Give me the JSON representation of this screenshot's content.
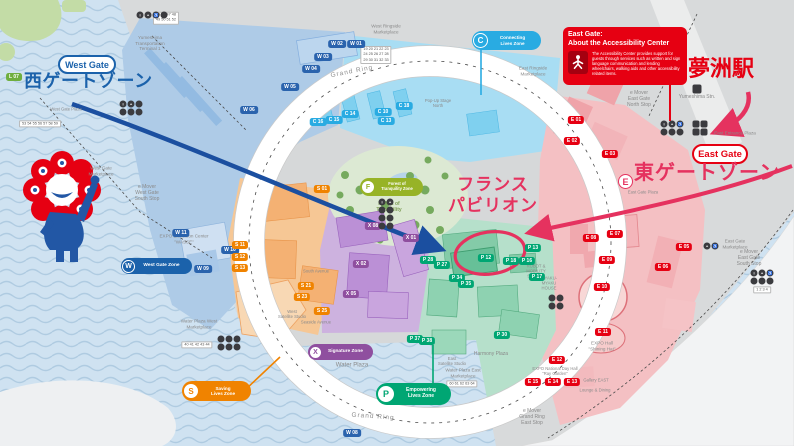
{
  "colors": {
    "water": "#cfe2f1",
    "land": "#d8dadb",
    "west_zone": "#1b62ab",
    "connecting_zone": "#29abe2",
    "saving_zone": "#f08300",
    "signature_zone": "#8f4f9f",
    "empowering_zone": "#00a673",
    "forest_zone": "#97b327",
    "east_zone": "#e60012",
    "annotation_pink": "#e5325f",
    "annotation_blue": "#1b4fa0"
  },
  "overlay": {
    "west_gate_pill": "West Gate",
    "west_zone_text": "西ゲートゾーン",
    "east_gate_pill": "East Gate",
    "east_zone_letter": "E",
    "east_zone_text": "東ゲートゾーン",
    "station_text": "夢洲駅",
    "france_text": "フランス\nパビリオン",
    "accessibility": {
      "title1": "East Gate:",
      "title2": "About the Accessibility Center",
      "body": "The Accessibility Center provides support for guests through services such as written and sign language communication and lending wheelchairs, walking aids and other accessibility related items."
    }
  },
  "zone_pills": [
    {
      "letter": "C",
      "label": "Connecting\nLives Zone"
    },
    {
      "letter": "W",
      "label": "West Gate Zone"
    },
    {
      "letter": "S",
      "label": "Saving\nLives Zone"
    },
    {
      "letter": "X",
      "label": "Signature Zone"
    },
    {
      "letter": "P",
      "label": "Empowering\nLives Zone"
    },
    {
      "letter": "F",
      "label": "Forest of\nTranquility Zone"
    }
  ],
  "labels": [
    "Grand Ring",
    "Grand Ring",
    "Water Plaza",
    "Harmony Plaza",
    "Forest of\nTranquility",
    "Yumeshima Stn.",
    "e Mover\nEast Gate\nNorth Stop",
    "e Mover\nEast Gate\nSouth Stop",
    "e Mover\nWest Gate\nSouth Stop",
    "e Mover\nGrand Ring\nEast Stop",
    "East Entrance Plaza",
    "East Gate\nMarketplace",
    "West Gate\nMarketplace",
    "EXPO Exhibition Center\n\"WASSE\"",
    "Water Plaza West\nMarketplace",
    "Water Plaza East\nMarketplace",
    "East\nSatellite Studio",
    "West\nSatellite Studio",
    "Seaside Avenue",
    "South Avenue",
    "East Ringside\nMarketplace",
    "West Ringside\nMarketplace",
    "EXPO Hall\n\"Shining Hat\"",
    "EXPO National Day Hall\n\"Ray Garden\"",
    "Gallery EAST",
    "Lounge & Dining",
    "Pop-Up Stage\nNorth",
    "ROBOT &\nMOBILITY\nSTATION",
    "MYAKU-\nMYAKU\nHOUSE",
    "Yumeshima\nTransportation\nTerminal 1",
    "East Gate Plaza",
    "West Gate Plaza",
    "45 46 47 48\n49 50 51 52",
    "60 61 62 63 64",
    "40 41 42 43 44",
    "53 54 55 56 57 58 59",
    "19 20 21 22 23\n24 25 26 27 28\n29 30 31 32 33",
    "1 2 3 4"
  ],
  "badges": [
    "W 01",
    "W 02",
    "W 03",
    "W 04",
    "W 05",
    "W 06",
    "W 08",
    "W 09",
    "W 10",
    "W 11",
    "C 10",
    "C 13",
    "C 14",
    "C 15",
    "C 16",
    "C 18",
    "E 01",
    "E 02",
    "E 03",
    "E 05",
    "E 06",
    "E 07",
    "E 08",
    "E 09",
    "E 10",
    "E 11",
    "E 12",
    "E 13",
    "E 14",
    "E 15",
    "S 01",
    "S 11",
    "S 12",
    "S 13",
    "S 21",
    "S 23",
    "S 25",
    "X 01",
    "X 02",
    "X 05",
    "X 08",
    "P 12",
    "P 13",
    "P 16",
    "P 18",
    "P 17",
    "P 27",
    "P 28",
    "P 30",
    "P 34",
    "P 35",
    "P 37",
    "P 38",
    "L 07"
  ],
  "icons": {
    "glyphs": [
      "i",
      "+",
      "♿"
    ]
  }
}
